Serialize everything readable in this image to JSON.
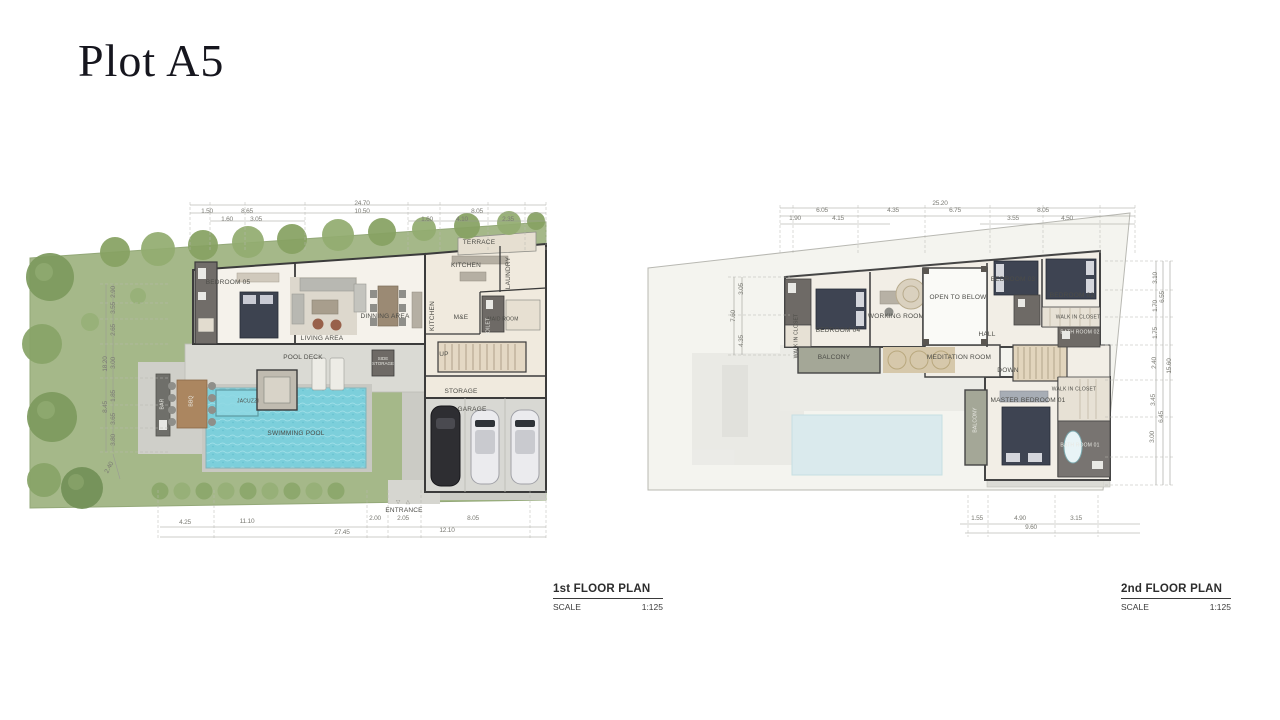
{
  "page": {
    "title": "Plot A5"
  },
  "first": {
    "title": "1st FLOOR PLAN",
    "scale_label": "SCALE",
    "scale_value": "1:125",
    "rooms": {
      "bedroom05": "BEDROOM 05",
      "living": "LIVING AREA",
      "dinning": "DINNING AREA",
      "kitchen_island": "KITCHEN",
      "kitchen": "KITCHEN",
      "terrace": "TERRACE",
      "laundry": "LAUNDRY",
      "maid_room": "MAID ROOM",
      "me": "M&E",
      "toilet": "TOILET",
      "side_storage": "SIDE STORAGE",
      "up": "UP",
      "storage": "STORAGE",
      "garage": "GARAGE",
      "entrance": "ENTRANCE",
      "entrance_marker": "▽ △",
      "pool_deck": "POOL DECK",
      "jacuzzi": "JACUZZI",
      "swimming_pool": "SWIMMING POOL",
      "bar": "BAR",
      "bbq": "BBQ"
    },
    "dims": {
      "top_total": "24.70",
      "top2": [
        "1.50",
        "8.65",
        "10.50",
        "8.05"
      ],
      "top3": [
        "1.60",
        "3.05",
        "1.60",
        "4.10",
        "2.35"
      ],
      "bottom1": [
        "4.25",
        "11.10",
        "2.00",
        "2.05",
        "8.05"
      ],
      "bottom_sub": "12.10",
      "bottom_total": "27.45",
      "left": [
        "2.90",
        "3.55",
        "2.65",
        "3.00",
        "1.85",
        "3.65",
        "3.80"
      ],
      "left_total_upper": "18.20",
      "left_total_lower": "8.45",
      "left_corner": "2.40"
    }
  },
  "second": {
    "title": "2nd FLOOR PLAN",
    "scale_label": "SCALE",
    "scale_value": "1:125",
    "rooms": {
      "bedroom04": "BEDROOM 04",
      "wic04": "WALK IN CLOSET",
      "working": "WORKING ROOM",
      "open_below": "OPEN TO BELOW",
      "bedroom03": "BEDROOM 03",
      "bedroom02": "BEDROOM 02",
      "wic02": "WALK IN CLOSET",
      "bath02": "BATH ROOM 02",
      "hall": "HALL",
      "balcony_left": "BALCONY",
      "meditation": "MEDITATION ROOM",
      "down": "DOWN",
      "master": "MASTER BEDROOM 01",
      "wic01": "WALK IN CLOSET",
      "bath01": "BATH ROOM 01",
      "balcony_right": "BALCONY"
    },
    "dims": {
      "top_total": "25.20",
      "top2": [
        "6.05",
        "4.35",
        "6.75",
        "8.05"
      ],
      "top3": [
        "1.90",
        "4.15",
        "3.55",
        "4.50"
      ],
      "bottom1": [
        "1.55",
        "4.90",
        "3.15"
      ],
      "bottom_total": "9.60",
      "left": [
        "3.05",
        "4.35"
      ],
      "left_total": "7.60",
      "right_inner": [
        "3.10",
        "1.70",
        "1.75",
        "2.40",
        "3.45",
        "3.00"
      ],
      "right_mid": [
        "6.55",
        "6.45"
      ],
      "right_total": "15.60"
    }
  }
}
